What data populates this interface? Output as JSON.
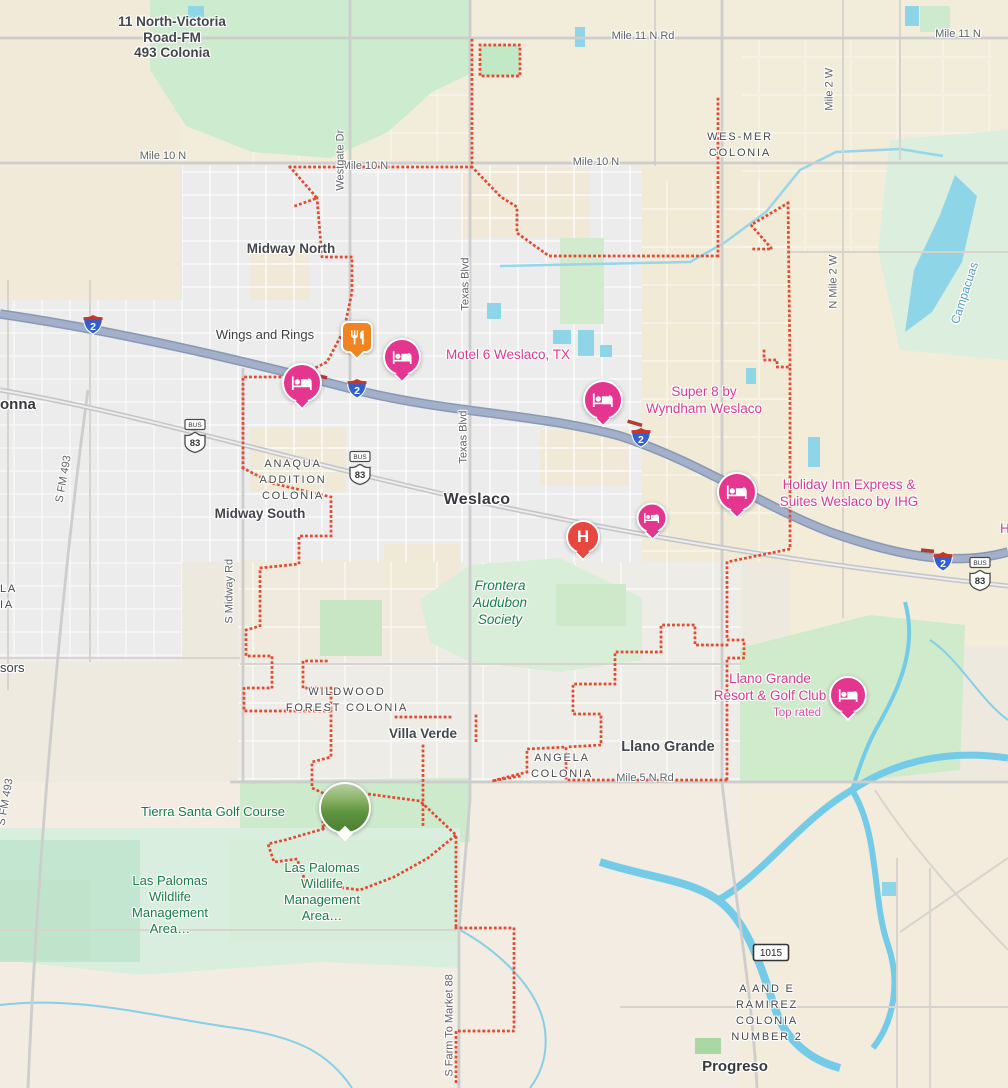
{
  "app": {
    "view": "map-canvas"
  },
  "colors": {
    "boundary_red": "#e2492e",
    "hotel_pin_pink": "#e5368f",
    "poi_pink_text": "#de3a8e",
    "poi_green_text": "#197c45",
    "hospital_red": "#e84740",
    "restaurant_orange": "#f08421",
    "expressway_blue_gray": "#9aa7c3",
    "water_blue": "#8ed5e8"
  },
  "map": {
    "labels": [
      {
        "name": "label-11-north-victoria-colonia",
        "cls": "locality center",
        "x": 172,
        "y": 14,
        "text": "11 North-Victoria\nRoad-FM\n493 Colonia",
        "inter": false
      },
      {
        "name": "road-mile-11-n-rd",
        "cls": "road center",
        "x": 643,
        "y": 30,
        "text": "Mile 11 N Rd",
        "inter": false
      },
      {
        "name": "road-mile-11-n",
        "cls": "road center",
        "x": 958,
        "y": 28,
        "text": "Mile 11 N",
        "inter": false
      },
      {
        "name": "label-wes-mer-colonia",
        "cls": "colonia center",
        "x": 740,
        "y": 130,
        "text": "WES-MER\nCOLONIA",
        "inter": false
      },
      {
        "name": "road-mile-10-n-1",
        "cls": "road center",
        "x": 163,
        "y": 150,
        "text": "Mile 10 N",
        "inter": false
      },
      {
        "name": "road-mile-10-n-2",
        "cls": "road center",
        "x": 365,
        "y": 160,
        "text": "Mile 10 N",
        "inter": false
      },
      {
        "name": "road-mile-10-n-3",
        "cls": "road center",
        "x": 596,
        "y": 156,
        "text": "Mile 10 N",
        "inter": false
      },
      {
        "name": "road-westgate-dr",
        "cls": "road vert",
        "x": 347,
        "y": 178,
        "rot": -90,
        "text": "Westgate Dr",
        "inter": false
      },
      {
        "name": "road-mile-2-w",
        "cls": "road vert",
        "x": 836,
        "y": 98,
        "rot": -90,
        "text": "Mile 2 W",
        "inter": false
      },
      {
        "name": "road-n-mile-2-w",
        "cls": "road vert",
        "x": 840,
        "y": 296,
        "rot": -90,
        "text": "N Mile 2 W",
        "inter": false
      },
      {
        "name": "water-label-campacuas",
        "cls": "water vert",
        "x": 962,
        "y": 312,
        "rot": -72,
        "text": "Campacuas",
        "inter": false
      },
      {
        "name": "label-midway-north",
        "cls": "locality center",
        "x": 291,
        "y": 241,
        "text": "Midway North",
        "inter": false
      },
      {
        "name": "poi-wings-and-rings",
        "cls": "poi-dark center",
        "x": 265,
        "y": 328,
        "text": "Wings and Rings",
        "inter": true
      },
      {
        "name": "poi-motel-6-weslaco",
        "cls": "poi-pink center",
        "x": 508,
        "y": 347,
        "text": "Motel 6 Weslaco, TX",
        "inter": true
      },
      {
        "name": "road-texas-blvd-1",
        "cls": "road vert",
        "x": 472,
        "y": 298,
        "rot": -90,
        "text": "Texas Blvd",
        "inter": false
      },
      {
        "name": "road-texas-blvd-2",
        "cls": "road vert",
        "x": 470,
        "y": 451,
        "rot": -90,
        "text": "Texas Blvd",
        "inter": false
      },
      {
        "name": "poi-super-8",
        "cls": "poi-pink center",
        "x": 704,
        "y": 384,
        "text": "Super 8 by\nWyndham Weslaco",
        "inter": true
      },
      {
        "name": "city-donna-cut",
        "cls": "city",
        "x": 0,
        "y": 396,
        "text": "onna",
        "inter": false
      },
      {
        "name": "road-n-main-st",
        "cls": "road vert",
        "x": 1,
        "y": 358,
        "rot": -90,
        "text": "N Main St",
        "inter": false
      },
      {
        "name": "poi-holiday-inn",
        "cls": "poi-pink center",
        "x": 849,
        "y": 477,
        "text": "Holiday Inn Express &\nSuites Weslaco by IHG",
        "inter": true
      },
      {
        "name": "label-anaqua-addition-colonia",
        "cls": "colonia center",
        "x": 293,
        "y": 457,
        "text": "ANAQUA\nADDITION\nCOLONIA",
        "inter": false
      },
      {
        "name": "city-weslaco",
        "cls": "city lg center",
        "x": 477,
        "y": 491,
        "text": "Weslaco",
        "inter": false
      },
      {
        "name": "label-midway-south",
        "cls": "locality center",
        "x": 260,
        "y": 506,
        "text": "Midway South",
        "inter": false
      },
      {
        "name": "road-s-midway-rd",
        "cls": "road vert",
        "x": 236,
        "y": 611,
        "rot": -90,
        "text": "S Midway Rd",
        "inter": false
      },
      {
        "name": "road-s-fm-493-1",
        "cls": "road vert",
        "x": 66,
        "y": 491,
        "rot": -80,
        "text": "S FM 493",
        "inter": false
      },
      {
        "name": "road-s-fm-493-2",
        "cls": "road vert",
        "x": 8,
        "y": 814,
        "rot": -80,
        "text": "S FM 493",
        "inter": false
      },
      {
        "name": "poi-frontera-audubon",
        "cls": "frontera center",
        "x": 500,
        "y": 578,
        "text": "Frontera\nAudubon\nSociety",
        "inter": true
      },
      {
        "name": "label-cut-la-ia",
        "cls": "colonia",
        "x": 0,
        "y": 582,
        "text": "LA\nIA",
        "inter": false
      },
      {
        "name": "label-cut-sors",
        "cls": "poi-dark",
        "x": 0,
        "y": 661,
        "text": "sors",
        "inter": false
      },
      {
        "name": "label-wildwood-forest-colonia",
        "cls": "colonia center",
        "x": 347,
        "y": 685,
        "text": "WILDWOOD\nFOREST COLONIA",
        "inter": false
      },
      {
        "name": "label-villa-verde",
        "cls": "locality center",
        "x": 423,
        "y": 726,
        "text": "Villa Verde",
        "inter": false
      },
      {
        "name": "label-angela-colonia",
        "cls": "colonia center",
        "x": 562,
        "y": 751,
        "text": "ANGELA\nCOLONIA",
        "inter": false
      },
      {
        "name": "label-llano-grande",
        "cls": "locality lg center",
        "x": 668,
        "y": 739,
        "text": "Llano Grande",
        "inter": false
      },
      {
        "name": "road-mile-5-n-rd",
        "cls": "road center",
        "x": 645,
        "y": 772,
        "text": "Mile 5 N Rd",
        "inter": false
      },
      {
        "name": "poi-llano-grande-resort",
        "cls": "poi-pink center",
        "x": 770,
        "y": 671,
        "text": "Llano Grande\nResort & Golf Club",
        "inter": true
      },
      {
        "name": "poi-llano-grande-top-rated",
        "cls": "top-rated center",
        "x": 797,
        "y": 707,
        "text": "Top rated",
        "inter": false
      },
      {
        "name": "poi-tierra-santa-golf",
        "cls": "poi-green center",
        "x": 213,
        "y": 804,
        "text": "Tierra Santa Golf Course",
        "inter": true
      },
      {
        "name": "poi-las-palomas-1",
        "cls": "poi-green center",
        "x": 170,
        "y": 873,
        "text": "Las Palomas\nWildlife\nManagement\nArea…",
        "inter": true
      },
      {
        "name": "poi-las-palomas-2",
        "cls": "poi-green center",
        "x": 322,
        "y": 860,
        "text": "Las Palomas\nWildlife\nManagement\nArea…",
        "inter": true
      },
      {
        "name": "road-s-farm-to-market-88",
        "cls": "road vert",
        "x": 456,
        "y": 1064,
        "rot": -90,
        "text": "S Farm To Market 88",
        "inter": false
      },
      {
        "name": "label-a-and-e-ramirez",
        "cls": "colonia center",
        "x": 767,
        "y": 982,
        "text": "A AND E\nRAMIREZ\nCOLONIA\nNUMBER 2",
        "inter": false
      },
      {
        "name": "city-progreso",
        "cls": "city center",
        "x": 735,
        "y": 1058,
        "text": "Progreso",
        "inter": false
      },
      {
        "name": "label-cut-h",
        "cls": "poi-pink",
        "x": 1000,
        "y": 521,
        "text": "H",
        "inter": false
      }
    ],
    "markers": [
      {
        "name": "pin-hotel-west",
        "type": "hotel",
        "x": 302,
        "y": 383,
        "s": 36
      },
      {
        "name": "pin-hotel-motel-6",
        "type": "hotel",
        "x": 402,
        "y": 357,
        "s": 34
      },
      {
        "name": "pin-hotel-super-8",
        "type": "hotel",
        "x": 603,
        "y": 400,
        "s": 36
      },
      {
        "name": "pin-hotel-holiday-inn",
        "type": "hotel",
        "x": 737,
        "y": 492,
        "s": 36
      },
      {
        "name": "pin-hotel-weslaco",
        "type": "hotel",
        "x": 652,
        "y": 518,
        "s": 27
      },
      {
        "name": "pin-hotel-llano-grande",
        "type": "hotel",
        "x": 848,
        "y": 695,
        "s": 34
      },
      {
        "name": "pin-hospital",
        "type": "hospital",
        "label": "H",
        "x": 583,
        "y": 537,
        "s": 30
      },
      {
        "name": "pin-restaurant-wings-and-rings",
        "type": "restaurant",
        "x": 357,
        "y": 337,
        "s": 28
      },
      {
        "name": "photo-tierra-santa-golf",
        "type": "photo",
        "x": 345,
        "y": 808,
        "s": 48
      }
    ],
    "shields": [
      {
        "name": "shield-i2-1",
        "type": "interstate",
        "label": "2",
        "x": 93,
        "y": 327
      },
      {
        "name": "shield-i2-2",
        "type": "interstate",
        "label": "2",
        "x": 357,
        "y": 391
      },
      {
        "name": "shield-i2-3",
        "type": "interstate",
        "label": "2",
        "x": 641,
        "y": 440
      },
      {
        "name": "shield-i2-4",
        "type": "interstate",
        "label": "2",
        "x": 943,
        "y": 564
      },
      {
        "name": "shield-bus83-1",
        "type": "us-bus",
        "bus": "BUS",
        "label": "83",
        "x": 195,
        "y": 441
      },
      {
        "name": "shield-bus83-2",
        "type": "us-bus",
        "bus": "BUS",
        "label": "83",
        "x": 360,
        "y": 473
      },
      {
        "name": "shield-bus83-3",
        "type": "us-bus",
        "bus": "BUS",
        "label": "83",
        "x": 980,
        "y": 579
      },
      {
        "name": "shield-fm1015",
        "type": "fm",
        "label": "1015",
        "x": 771,
        "y": 955
      }
    ]
  }
}
